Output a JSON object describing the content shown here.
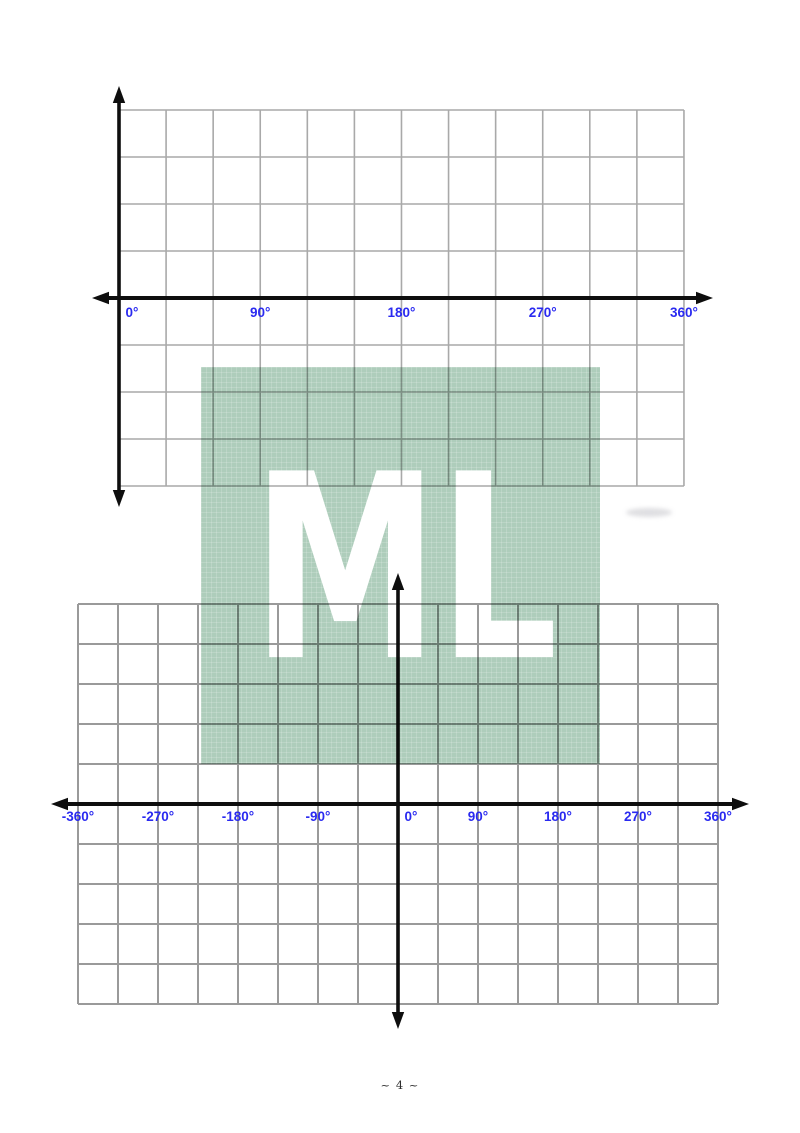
{
  "page": {
    "number_label": "~ 4 ~"
  },
  "colors": {
    "label_blue": "#2a2af0",
    "grid_line_top": "#a9a9a9",
    "grid_line_bottom": "#9a9a9a",
    "axis_black": "#0e0e0e",
    "watermark_green": "#aecdbb"
  },
  "watermark": {
    "text": "ML"
  },
  "top_grid": {
    "x_tick_labels": [
      "0°",
      "90°",
      "180°",
      "270°",
      "360°"
    ],
    "x_range_degrees": [
      0,
      360
    ],
    "cells_x": 12,
    "cells_y": 8,
    "degrees_per_cell": 30
  },
  "bottom_grid": {
    "x_tick_labels": [
      "-360°",
      "-270°",
      "-180°",
      "-90°",
      "0°",
      "90°",
      "180°",
      "270°",
      "360°"
    ],
    "x_range_degrees": [
      -360,
      360
    ],
    "cells_x": 16,
    "cells_y": 10,
    "degrees_per_cell": 45
  }
}
